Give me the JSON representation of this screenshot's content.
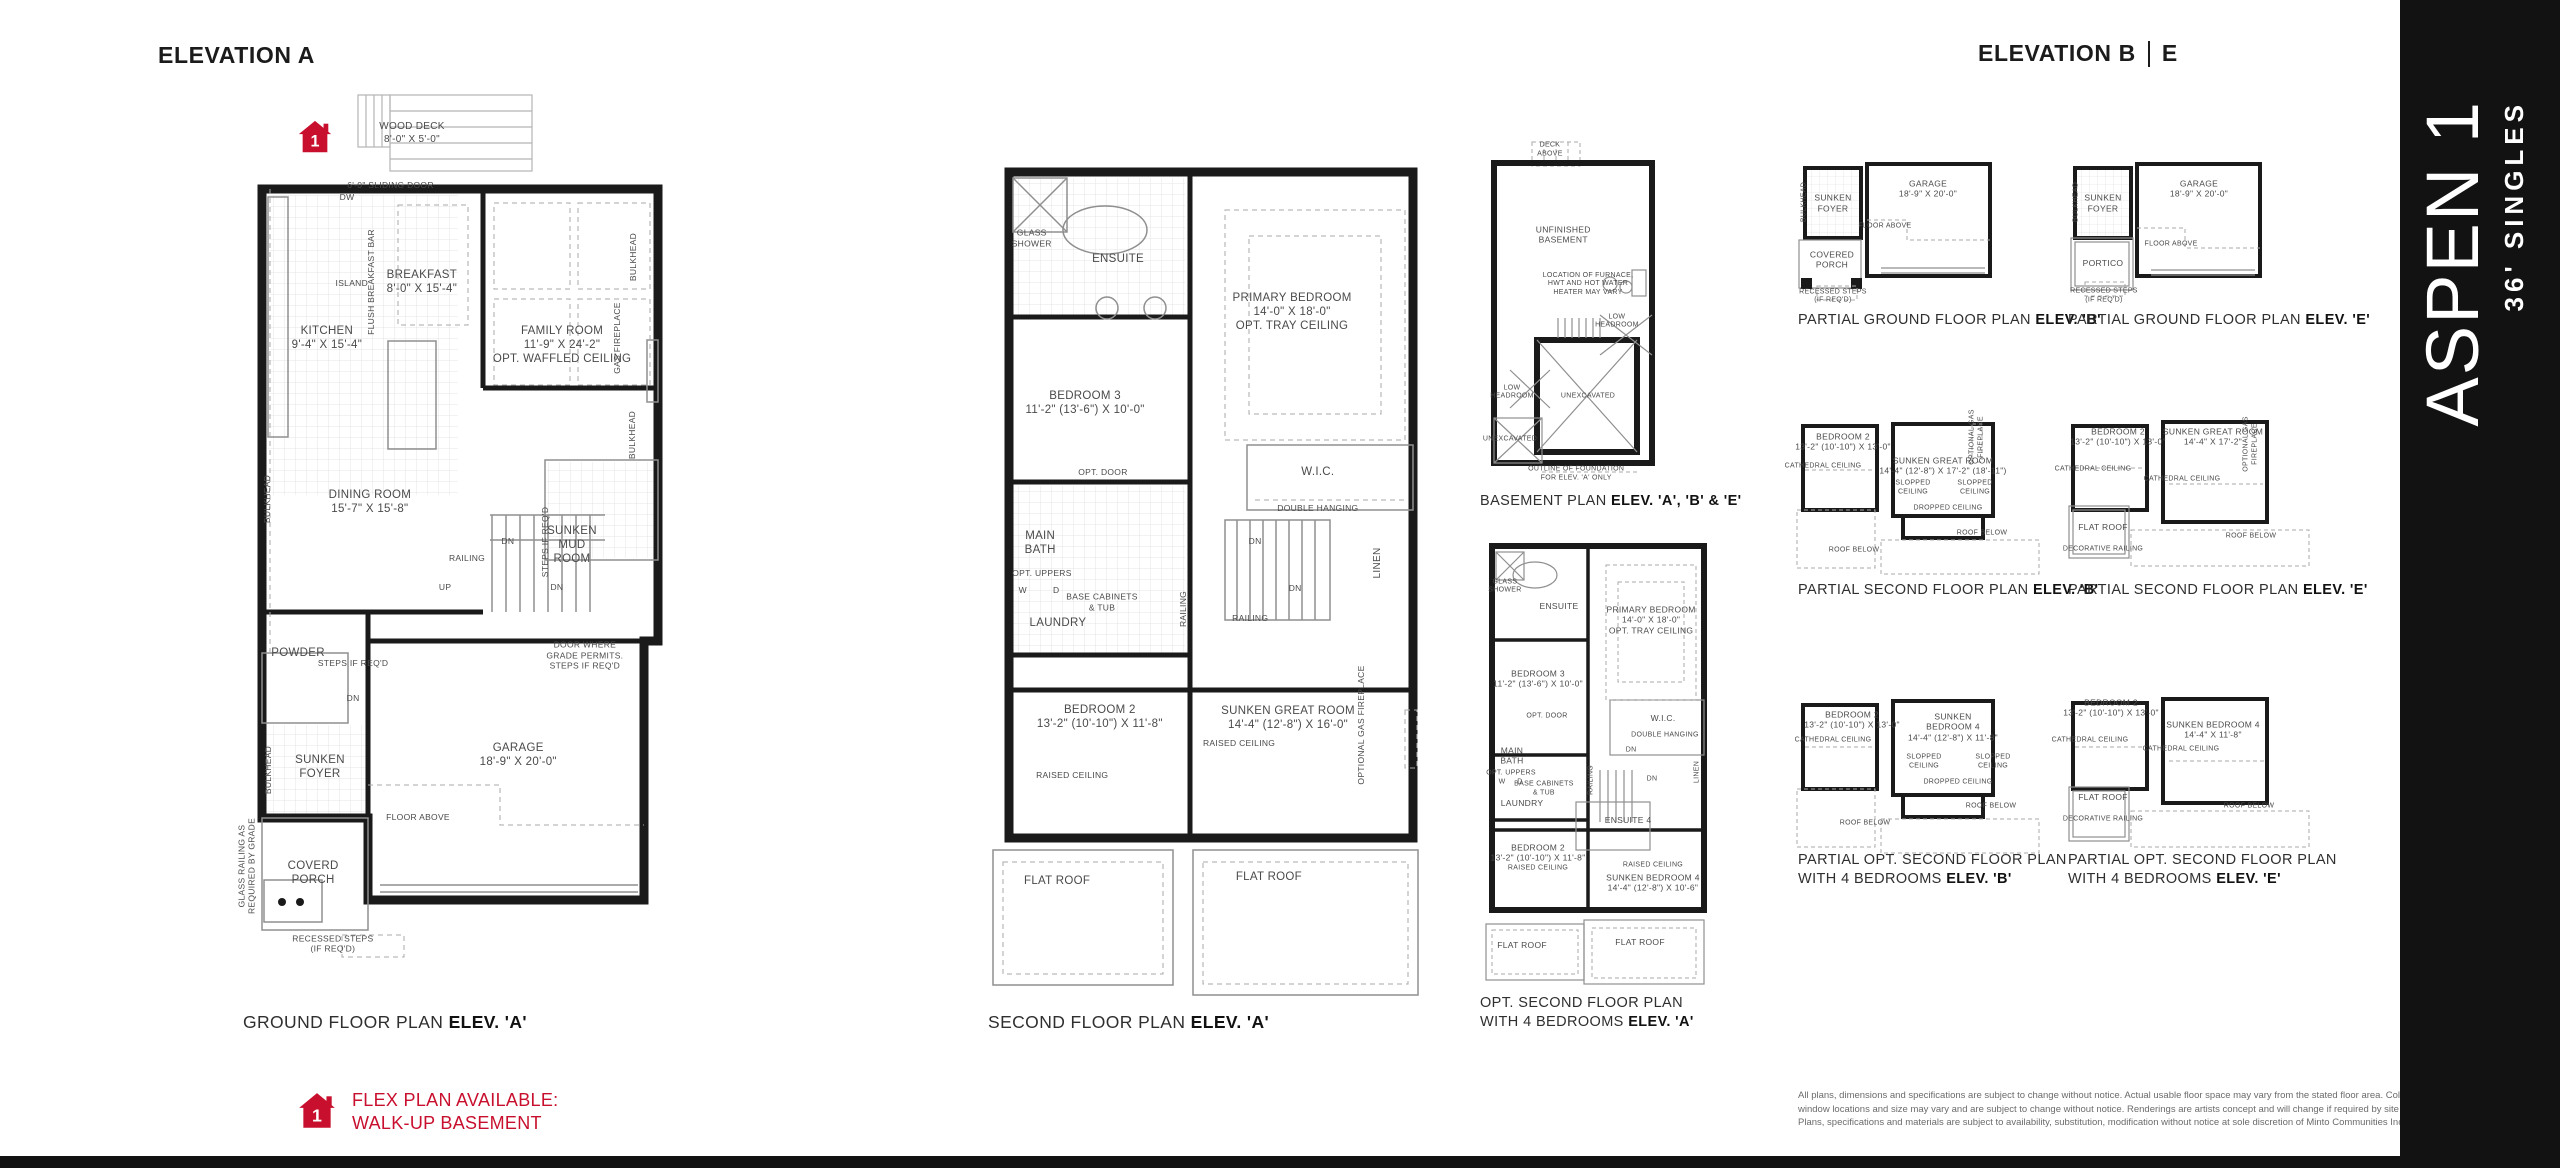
{
  "colors": {
    "red": "#c8102e",
    "wall": "#1a1a1a",
    "banner_bg": "#121212",
    "label": "#4a4a4a"
  },
  "headers": {
    "left": "ELEVATION A",
    "right_main": "ELEVATION B",
    "right_e": "E"
  },
  "banner": {
    "title": "ASPEN 1",
    "subtitle": "36' SINGLES"
  },
  "flex_note": {
    "badge": "1",
    "line1": "FLEX PLAN AVAILABLE:",
    "line2": "WALK-UP BASEMENT"
  },
  "captions": {
    "ground": {
      "pre": "GROUND FLOOR PLAN ",
      "bold": "ELEV. 'A'"
    },
    "second": {
      "pre": "SECOND FLOOR PLAN ",
      "bold": "ELEV. 'A'"
    },
    "basement": {
      "pre": "BASEMENT PLAN ",
      "bold": "ELEV. 'A', 'B' & 'E'"
    },
    "opt4_line1": "OPT. SECOND FLOOR PLAN",
    "opt4_line2_pre": "WITH 4 BEDROOMS ",
    "opt4_line2_bold": "ELEV. 'A'",
    "pg_b": {
      "pre": "PARTIAL GROUND FLOOR PLAN ",
      "bold": "ELEV. 'B'"
    },
    "pg_e": {
      "pre": "PARTIAL GROUND FLOOR PLAN ",
      "bold": "ELEV. 'E'"
    },
    "ps_b": {
      "pre": "PARTIAL SECOND FLOOR PLAN ",
      "bold": "ELEV. 'B'"
    },
    "ps_e": {
      "pre": "PARTIAL SECOND FLOOR PLAN ",
      "bold": "ELEV. 'E'"
    },
    "po_line1": "PARTIAL OPT. SECOND FLOOR PLAN",
    "po_b2_pre": "WITH 4 BEDROOMS ",
    "po_b2_bold": "ELEV. 'B'",
    "po_e2_pre": "WITH 4 BEDROOMS ",
    "po_e2_bold": "ELEV. 'E'"
  },
  "plans": {
    "ground": {
      "labels": [
        {
          "t": "WOOD DECK\n8'-0\" X 5'-0\"",
          "x": 40,
          "y": 5.5,
          "s": 1
        },
        {
          "t": "6'-0\" SLIDING DOOR",
          "x": 35,
          "y": 11.4,
          "s": 2
        },
        {
          "t": "DW",
          "x": 24.9,
          "y": 12.7,
          "s": 2
        },
        {
          "t": "ISLAND",
          "x": 26,
          "y": 22.5,
          "s": 2
        },
        {
          "t": "FLUSH BREAKFAST BAR",
          "x": 30.5,
          "y": 22.4,
          "s": 2,
          "r": 1
        },
        {
          "t": "BREAKFAST\n8'-0\" X 15'-4\"",
          "x": 42.3,
          "y": 22.4,
          "s": 0
        },
        {
          "t": "KITCHEN\n9'-4\" X 15'-4\"",
          "x": 20.2,
          "y": 28.8,
          "s": 0
        },
        {
          "t": "FAMILY ROOM\n11'-9\" X 24'-2\"\nOPT. WAFFLED CEILING",
          "x": 74.9,
          "y": 29.5,
          "s": 0
        },
        {
          "t": "GAS FIREPLACE",
          "x": 87.7,
          "y": 28.8,
          "s": 2,
          "r": 1
        },
        {
          "t": "BULKHEAD",
          "x": 91.4,
          "y": 19.5,
          "s": 2,
          "r": 1
        },
        {
          "t": "BULKHEAD",
          "x": 91.2,
          "y": 39.8,
          "s": 2,
          "r": 1
        },
        {
          "t": "BULKHEAD",
          "x": 6.3,
          "y": 47,
          "s": 2,
          "r": 1
        },
        {
          "t": "DINING ROOM\n15'-7\" X 15'-8\"",
          "x": 30.2,
          "y": 47.4,
          "s": 0
        },
        {
          "t": "RAILING",
          "x": 52.8,
          "y": 53.8,
          "s": 2
        },
        {
          "t": "UP",
          "x": 47.7,
          "y": 57,
          "s": 2
        },
        {
          "t": "DN",
          "x": 62.3,
          "y": 51.8,
          "s": 2
        },
        {
          "t": "STEPS IF REQ'D",
          "x": 70.9,
          "y": 51.9,
          "s": 2,
          "r": 1
        },
        {
          "t": "SUNKEN\nMUD\nROOM",
          "x": 77.2,
          "y": 52.3,
          "s": 0
        },
        {
          "t": "DN",
          "x": 73.7,
          "y": 57,
          "s": 2
        },
        {
          "t": "POWDER",
          "x": 13.5,
          "y": 64.6,
          "s": 0
        },
        {
          "t": "STEPS IF REQ'D",
          "x": 26.3,
          "y": 65.7,
          "s": 2
        },
        {
          "t": "DOOR WHERE\nGRADE PERMITS.\nSTEPS IF REQ'D",
          "x": 80.2,
          "y": 64.8,
          "s": 2
        },
        {
          "t": "DN",
          "x": 26.3,
          "y": 69.7,
          "s": 2
        },
        {
          "t": "GARAGE\n18'-9\" X 20'-0\"",
          "x": 64.7,
          "y": 76.1,
          "s": 0
        },
        {
          "t": "SUNKEN\nFOYER",
          "x": 18.6,
          "y": 77.5,
          "s": 0
        },
        {
          "t": "BULKHEAD",
          "x": 6.5,
          "y": 77.8,
          "s": 2,
          "r": 1
        },
        {
          "t": "FLOOR ABOVE",
          "x": 41.4,
          "y": 83.2,
          "s": 2
        },
        {
          "t": "COVERD\nPORCH",
          "x": 17,
          "y": 89.5,
          "s": 0
        },
        {
          "t": "GLASS RAILING AS\nREQUIRED BY GRADE",
          "x": 1.6,
          "y": 88.8,
          "s": 2,
          "r": 1
        },
        {
          "t": "RECESSED STEPS\n(IF REQ'D)",
          "x": 21.6,
          "y": 97.6,
          "s": 2
        }
      ]
    },
    "second": {
      "labels": [
        {
          "t": "GLASS\nSHOWER",
          "x": 10.5,
          "y": 10.4,
          "s": 2
        },
        {
          "t": "ENSUITE",
          "x": 29.9,
          "y": 12.8,
          "s": 0
        },
        {
          "t": "PRIMARY BEDROOM\n14'-0\" X 18'-0\"\nOPT. TRAY CEILING",
          "x": 69,
          "y": 19,
          "s": 0
        },
        {
          "t": "BEDROOM 3\n11'-2\" (13'-6\") X 10'-0\"",
          "x": 22.5,
          "y": 29.8,
          "s": 0
        },
        {
          "t": "OPT. DOOR",
          "x": 26.5,
          "y": 37.9,
          "s": 2
        },
        {
          "t": "W.I.C.",
          "x": 74.8,
          "y": 37.9,
          "s": 0
        },
        {
          "t": "DOUBLE HANGING",
          "x": 74.8,
          "y": 42.1,
          "s": 2
        },
        {
          "t": "DN",
          "x": 60.7,
          "y": 46,
          "s": 2
        },
        {
          "t": "MAIN\nBATH",
          "x": 12.4,
          "y": 46.2,
          "s": 0
        },
        {
          "t": "LINEN",
          "x": 88.3,
          "y": 48.6,
          "s": 1,
          "r": 1
        },
        {
          "t": "OPT. UPPERS",
          "x": 12.8,
          "y": 49.8,
          "s": 2
        },
        {
          "t": "W",
          "x": 8.5,
          "y": 51.8,
          "s": 2
        },
        {
          "t": "D",
          "x": 16,
          "y": 51.8,
          "s": 2
        },
        {
          "t": "BASE CABINETS\n& TUB",
          "x": 26.3,
          "y": 53.2,
          "s": 2
        },
        {
          "t": "DN",
          "x": 69.7,
          "y": 51.5,
          "s": 2
        },
        {
          "t": "RAILING",
          "x": 44.5,
          "y": 54,
          "s": 2,
          "r": 1
        },
        {
          "t": "RAILING",
          "x": 59.6,
          "y": 55.1,
          "s": 2
        },
        {
          "t": "LAUNDRY",
          "x": 16.4,
          "y": 55.7,
          "s": 0
        },
        {
          "t": "BEDROOM 2\n13'-2\" (10'-10\") X 11'-8\"",
          "x": 25.8,
          "y": 66.7,
          "s": 0
        },
        {
          "t": "SUNKEN GREAT ROOM\n14'-4\" (12'-8\") X 16'-0\"",
          "x": 68.1,
          "y": 66.8,
          "s": 0
        },
        {
          "t": "RAISED CEILING",
          "x": 57.1,
          "y": 69.8,
          "s": 2
        },
        {
          "t": "RAISED CEILING",
          "x": 19.6,
          "y": 73.5,
          "s": 2
        },
        {
          "t": "OPTIONAL GAS FIREPLACE",
          "x": 84.5,
          "y": 67.6,
          "s": 2,
          "r": 1
        },
        {
          "t": "FLAT ROOF",
          "x": 16.2,
          "y": 86,
          "s": 0
        },
        {
          "t": "FLAT ROOF",
          "x": 63.8,
          "y": 85.5,
          "s": 0
        }
      ]
    },
    "basement": {
      "labels": [
        {
          "t": "DECK\nABOVE",
          "x": 37.8,
          "y": 2.8,
          "s": 3
        },
        {
          "t": "UNFINISHED\nBASEMENT",
          "x": 45,
          "y": 26,
          "s": 2
        },
        {
          "t": "LOCATION OF FURNACE,\nHWT AND HOT WATER\nHEATER MAY VARY",
          "x": 58.4,
          "y": 39.7,
          "s": 3
        },
        {
          "t": "LOW\nHEADROOM",
          "x": 74,
          "y": 49.8,
          "s": 3
        },
        {
          "t": "LOW\nHEADROOM",
          "x": 17.3,
          "y": 69.3,
          "s": 3
        },
        {
          "t": "UNEXCAVATED",
          "x": 58.4,
          "y": 70.4,
          "s": 3
        },
        {
          "t": "UNEXCAVATED",
          "x": 16.2,
          "y": 82.2,
          "s": 3
        },
        {
          "t": "OUTLINE OF FOUNDATION\nFOR ELEV. 'A' ONLY",
          "x": 52,
          "y": 91.5,
          "s": 3
        }
      ]
    },
    "opt4": {
      "labels": [
        {
          "t": "GLASS\nSHOWER",
          "x": 10.6,
          "y": 10.4,
          "s": 3
        },
        {
          "t": "ENSUITE",
          "x": 33.6,
          "y": 14.7,
          "s": 2
        },
        {
          "t": "PRIMARY BEDROOM\n14'-0\" X 18'-0\"\nOPT. TRAY CEILING",
          "x": 72.8,
          "y": 17.8,
          "s": 2
        },
        {
          "t": "BEDROOM 3\n11'-2\" (13'-6\") X 10'-0\"",
          "x": 24.7,
          "y": 30.9,
          "s": 2
        },
        {
          "t": "OPT. DOOR",
          "x": 28.5,
          "y": 39.3,
          "s": 3
        },
        {
          "t": "W.I.C.",
          "x": 77.9,
          "y": 39.6,
          "s": 2
        },
        {
          "t": "DOUBLE HANGING",
          "x": 78.7,
          "y": 43.6,
          "s": 3
        },
        {
          "t": "DN",
          "x": 64.3,
          "y": 46.9,
          "s": 3
        },
        {
          "t": "MAIN\nBATH",
          "x": 13.6,
          "y": 48,
          "s": 2
        },
        {
          "t": "LINEN",
          "x": 92.8,
          "y": 51.6,
          "s": 3,
          "r": 1
        },
        {
          "t": "OPT. UPPERS",
          "x": 13.2,
          "y": 52,
          "s": 3
        },
        {
          "t": "W",
          "x": 9.4,
          "y": 54,
          "s": 3
        },
        {
          "t": "D",
          "x": 17,
          "y": 54,
          "s": 3
        },
        {
          "t": "BASE CABINETS\n& TUB",
          "x": 27.2,
          "y": 55.4,
          "s": 3
        },
        {
          "t": "RAILING",
          "x": 47.7,
          "y": 53.3,
          "s": 3,
          "r": 1
        },
        {
          "t": "DN",
          "x": 73.2,
          "y": 53.3,
          "s": 3
        },
        {
          "t": "LAUNDRY",
          "x": 17.9,
          "y": 58.4,
          "s": 2
        },
        {
          "t": "ENSUITE 4",
          "x": 63,
          "y": 62.2,
          "s": 2
        },
        {
          "t": "BEDROOM 2\n13'-2\" (10'-10\") X 11'-8\"",
          "x": 24.7,
          "y": 69.5,
          "s": 2
        },
        {
          "t": "RAISED CEILING",
          "x": 24.7,
          "y": 73.1,
          "s": 3
        },
        {
          "t": "RAISED CEILING",
          "x": 73.6,
          "y": 72.4,
          "s": 3
        },
        {
          "t": "SUNKEN BEDROOM 4\n14'-4\" (12'-8\") X 10'-6\"",
          "x": 73.6,
          "y": 76.2,
          "s": 2
        },
        {
          "t": "FLAT ROOF",
          "x": 17.9,
          "y": 90,
          "s": 2
        },
        {
          "t": "FLAT ROOF",
          "x": 68.1,
          "y": 89.3,
          "s": 2
        }
      ]
    },
    "pg_b": {
      "labels": [
        {
          "t": "SUNKEN\nFOYER",
          "x": 15.5,
          "y": 27,
          "s": 2
        },
        {
          "t": "GARAGE\n18'-9\" X 20'-0\"",
          "x": 54.3,
          "y": 18.1,
          "s": 2
        },
        {
          "t": "FLOOR ABOVE",
          "x": 36.7,
          "y": 41.9,
          "s": 3
        },
        {
          "t": "COVERED\nPORCH",
          "x": 15.1,
          "y": 62.5,
          "s": 2
        },
        {
          "t": "RECESSED STEPS\n(IF REQ'D)",
          "x": 15.5,
          "y": 85.6,
          "s": 3
        },
        {
          "t": "BULKHEAD",
          "x": 4.1,
          "y": 26.3,
          "s": 3,
          "r": 1
        }
      ]
    },
    "pg_e": {
      "labels": [
        {
          "t": "SUNKEN\nFOYER",
          "x": 15.5,
          "y": 27,
          "s": 2
        },
        {
          "t": "GARAGE\n18'-9\" X 20'-0\"",
          "x": 54.7,
          "y": 18.1,
          "s": 2
        },
        {
          "t": "FLOOR ABOVE",
          "x": 43.3,
          "y": 53.1,
          "s": 3
        },
        {
          "t": "PORTICO",
          "x": 15.5,
          "y": 64.4,
          "s": 2
        },
        {
          "t": "RECESSED STEPS\n(IF REQ'D)",
          "x": 15.9,
          "y": 85,
          "s": 3
        },
        {
          "t": "BULKHEAD",
          "x": 4.9,
          "y": 26.3,
          "s": 3,
          "r": 1
        }
      ]
    },
    "ps_b": {
      "labels": [
        {
          "t": "BEDROOM 2\n13'-2\" (10'-10\") X 13'-0\"",
          "x": 19.2,
          "y": 13,
          "s": 2
        },
        {
          "t": "CATHEDRAL CEILING",
          "x": 11.2,
          "y": 27.6,
          "s": 3
        },
        {
          "t": "SUNKEN GREAT ROOM\n14'-4\" (12'-8\") X 17'-2\" (18'-11\")",
          "x": 59.2,
          "y": 27,
          "s": 2
        },
        {
          "t": "OPTIONAL GAS\nFIREPLACE",
          "x": 72.6,
          "y": 10,
          "s": 3,
          "r": 1
        },
        {
          "t": "SLOPPED\nCEILING",
          "x": 47.2,
          "y": 40,
          "s": 3
        },
        {
          "t": "SLOPPED\nCEILING",
          "x": 72,
          "y": 40,
          "s": 3
        },
        {
          "t": "DROPPED CEILING",
          "x": 61.2,
          "y": 52.4,
          "s": 3
        },
        {
          "t": "ROOF BELOW",
          "x": 74.8,
          "y": 67.1,
          "s": 3
        },
        {
          "t": "ROOF BELOW",
          "x": 23.6,
          "y": 77.1,
          "s": 3
        }
      ]
    },
    "ps_e": {
      "labels": [
        {
          "t": "BEDROOM 2\n13'-2\" (10'-10\") X 13'-0\"",
          "x": 21.2,
          "y": 10,
          "s": 2
        },
        {
          "t": "SUNKEN GREAT ROOM\n14'-4\" X 17'-2\"",
          "x": 59.2,
          "y": 10,
          "s": 2
        },
        {
          "t": "CATHEDRAL CEILING",
          "x": 11.2,
          "y": 29.4,
          "s": 3
        },
        {
          "t": "CATHEDRAL CEILING",
          "x": 46.8,
          "y": 35.3,
          "s": 3
        },
        {
          "t": "OPTIONAL GAS\nFIREPLACE",
          "x": 74.2,
          "y": 14,
          "s": 3,
          "r": 1
        },
        {
          "t": "FLAT ROOF",
          "x": 15.2,
          "y": 62.9,
          "s": 2
        },
        {
          "t": "DECORATIVE RAILING",
          "x": 15.2,
          "y": 76.5,
          "s": 3
        },
        {
          "t": "ROOF BELOW",
          "x": 74.4,
          "y": 68.8,
          "s": 3
        }
      ]
    },
    "po_b": {
      "labels": [
        {
          "t": "BEDROOM 2\n13'-2\" (10'-10\") X 13'-0\"",
          "x": 22.8,
          "y": 13.5,
          "s": 2
        },
        {
          "t": "CATHEDRAL CEILING",
          "x": 15.2,
          "y": 24.9,
          "s": 3
        },
        {
          "t": "SUNKEN\nBEDROOM 4\n14'-4\" (12'-8\") X 11'-8\"",
          "x": 63.2,
          "y": 17.3,
          "s": 2
        },
        {
          "t": "SLOPPED\nCEILING",
          "x": 51.6,
          "y": 36.2,
          "s": 3
        },
        {
          "t": "SLOPPED\nCEILING",
          "x": 79.2,
          "y": 36.2,
          "s": 3
        },
        {
          "t": "DROPPED CEILING",
          "x": 65.2,
          "y": 47.6,
          "s": 3
        },
        {
          "t": "ROOF BELOW",
          "x": 78.4,
          "y": 60.5,
          "s": 3
        },
        {
          "t": "ROOF BELOW",
          "x": 28,
          "y": 69.7,
          "s": 3
        }
      ]
    },
    "po_e": {
      "labels": [
        {
          "t": "BEDROOM 2\n13'-2\" (10'-10\") X 13'-0\"",
          "x": 18.4,
          "y": 7,
          "s": 2
        },
        {
          "t": "SUNKEN BEDROOM 4\n14'-4\" X 11'-8\"",
          "x": 59.2,
          "y": 18.9,
          "s": 2
        },
        {
          "t": "CATHEDRAL CEILING",
          "x": 10,
          "y": 24.9,
          "s": 3
        },
        {
          "t": "CATHEDRAL CEILING",
          "x": 46.4,
          "y": 29.7,
          "s": 3
        },
        {
          "t": "FLAT ROOF",
          "x": 15.2,
          "y": 55.1,
          "s": 2
        },
        {
          "t": "DECORATIVE RAILING",
          "x": 15.2,
          "y": 67.6,
          "s": 3
        },
        {
          "t": "ROOF BELOW",
          "x": 73.6,
          "y": 60.5,
          "s": 3
        }
      ]
    }
  },
  "legal": {
    "line1": "All plans, dimensions and specifications are subject to change without notice. Actual usable floor space may vary from the stated floor area. Column locations,",
    "line2": "window locations and size may vary and are subject to change without notice. Renderings are artists concept and will change if required by site conditions.",
    "line3": "Plans, specifications and materials are subject to availability, substitution, modification without notice at sole discretion of Minto Communities Inc. & Metropia. E. & O.E."
  }
}
